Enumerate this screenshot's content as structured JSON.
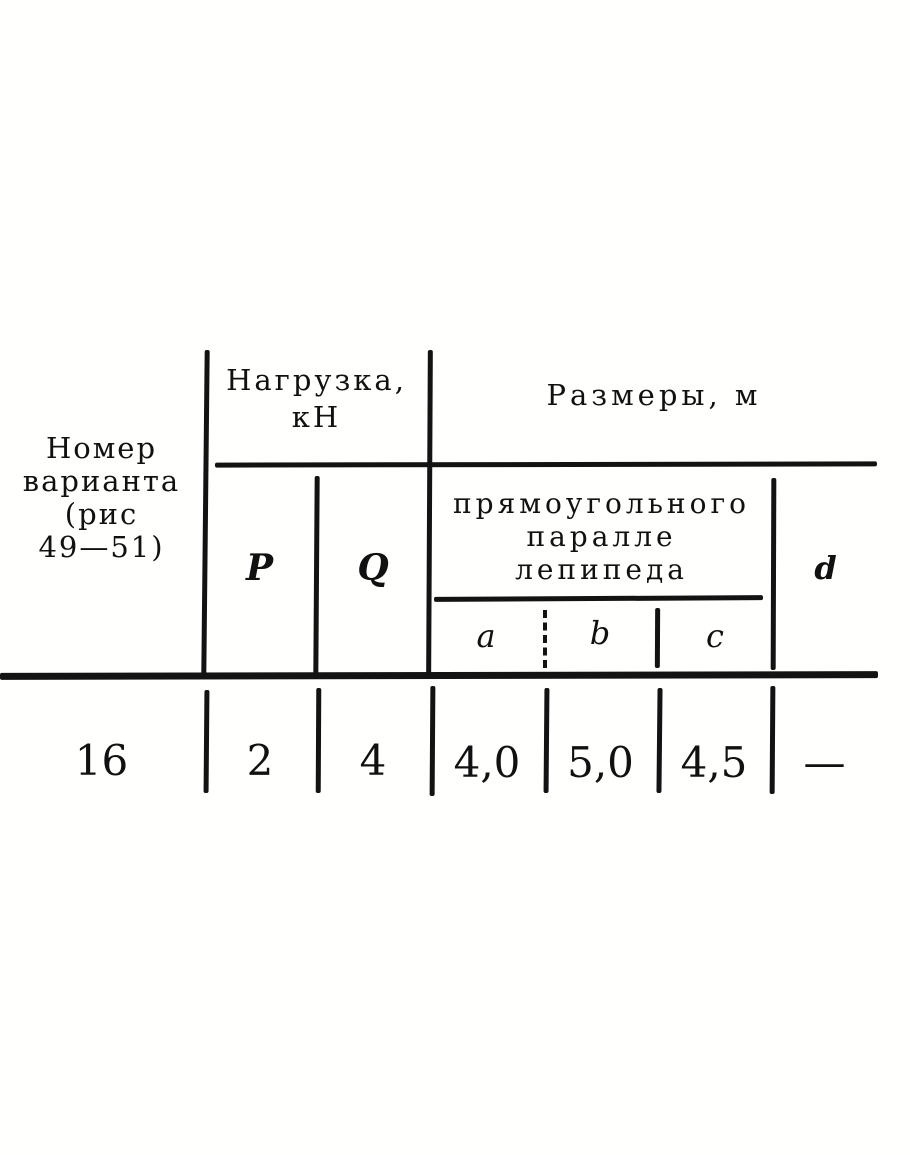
{
  "page": {
    "background": "#fcfbf9",
    "ink_color": "#161616"
  },
  "table": {
    "variant_header": {
      "lines": [
        "Номер",
        "варианта",
        "(рис",
        "49—51)"
      ]
    },
    "load_header": {
      "lines": [
        "Нагрузка,",
        "кН"
      ]
    },
    "dimensions_header": "Размеры, м",
    "parallelepiped_header": {
      "lines": [
        "прямоугольного",
        "паралле",
        "лепипеда"
      ]
    },
    "columns": {
      "P": "P",
      "Q": "Q",
      "a": "a",
      "b": "b",
      "c": "c",
      "d": "d"
    },
    "row": {
      "variant": "16",
      "P": "2",
      "Q": "4",
      "a": "4,0",
      "b": "5,0",
      "c": "4,5",
      "d": "—"
    }
  }
}
